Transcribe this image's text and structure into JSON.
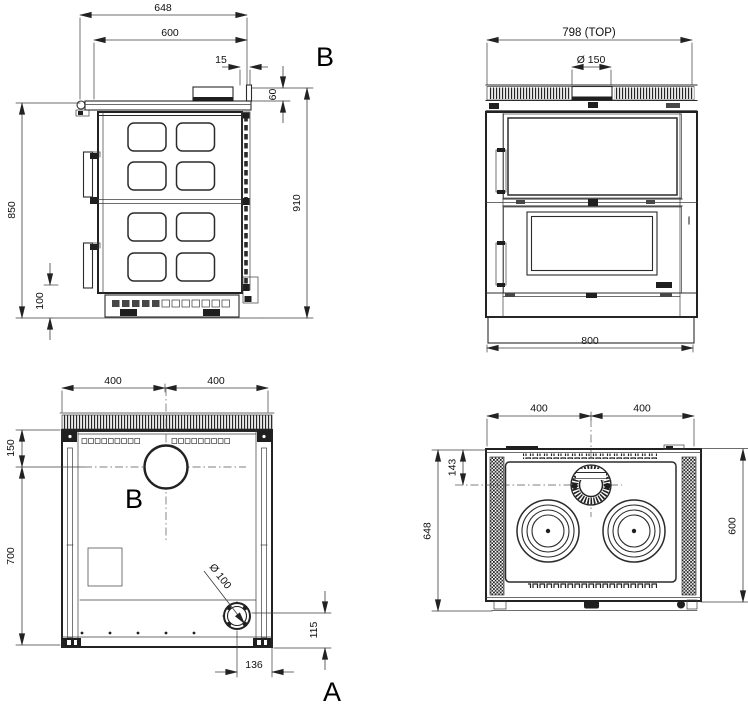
{
  "side": {
    "width_total": "648",
    "width_plate": "600",
    "flue_offset": "15",
    "flue_upstand_height": "60",
    "height_total": "910",
    "height_body": "850",
    "base_height": "100",
    "flue_label": "B"
  },
  "front": {
    "width_top": "798  (TOP)",
    "flue_diameter": "Ø 150",
    "width_base": "800"
  },
  "rear": {
    "width_left": "400",
    "width_right": "400",
    "flue_center_drop": "150",
    "panel_height": "700",
    "flue_label": "B",
    "air_inlet_diameter": "Ø 100",
    "air_inlet_height": "115",
    "air_inlet_offset": "136",
    "air_inlet_label": "A"
  },
  "plan": {
    "width_left": "400",
    "width_right": "400",
    "flue_center_depth": "143",
    "depth_total": "648",
    "depth_top": "600"
  }
}
